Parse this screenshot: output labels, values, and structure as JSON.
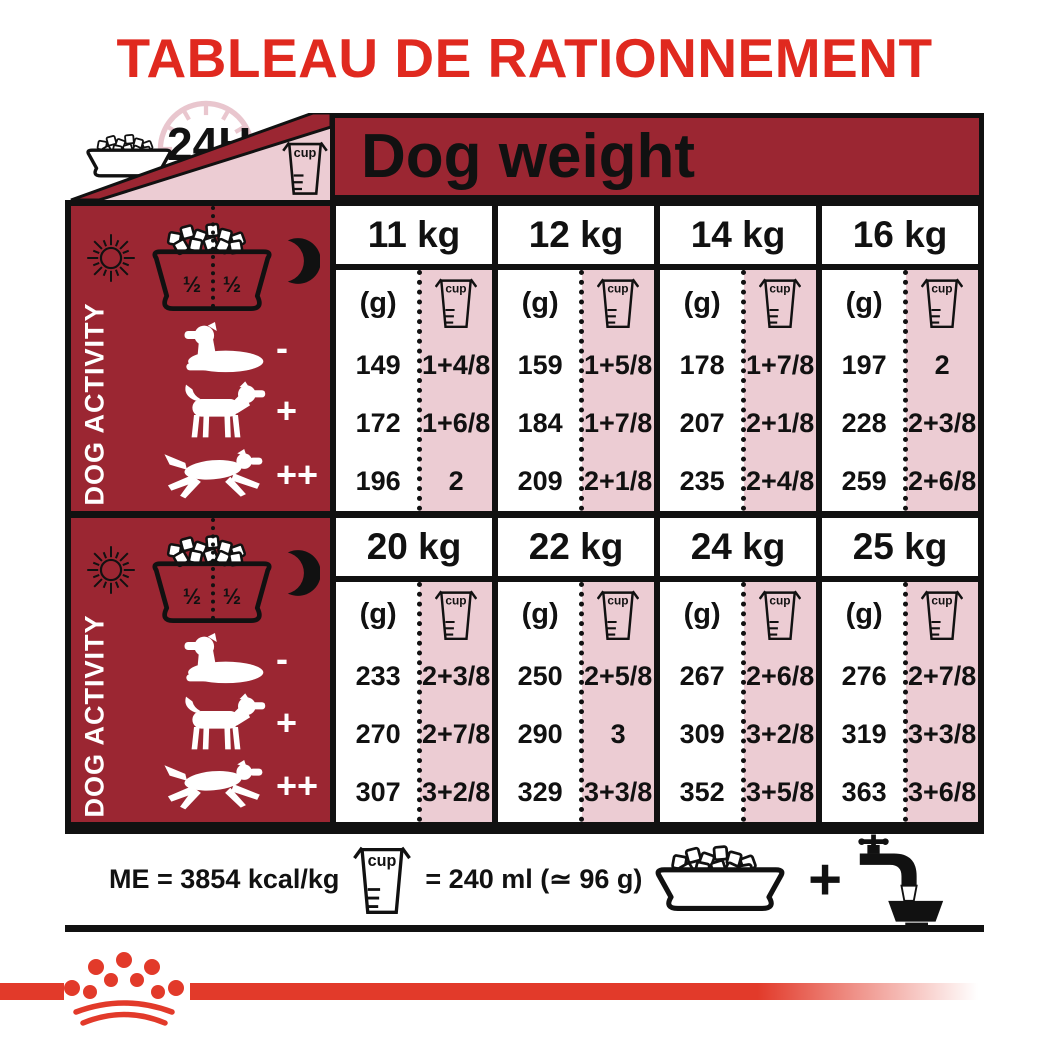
{
  "title": "TABLEAU DE RATIONNEMENT",
  "colors": {
    "accent_red": "#E0291F",
    "table_dark_red": "#9B2632",
    "pink": "#ECCCD3",
    "logo_red": "#E23A2A",
    "black": "#111111"
  },
  "top": {
    "daily": "24H",
    "cup": "cup",
    "dog_weight": "Dog weight"
  },
  "labels": {
    "unit_g": "(g)"
  },
  "activity": {
    "label": "DOG ACTIVITY",
    "half_left": "½",
    "half_right": "½",
    "markers": [
      "-",
      "+",
      "++"
    ]
  },
  "tables": [
    {
      "weights": [
        "11 kg",
        "12 kg",
        "14 kg",
        "16 kg"
      ],
      "rows": [
        {
          "cells": [
            {
              "g": "149",
              "cup": "1+4/8"
            },
            {
              "g": "159",
              "cup": "1+5/8"
            },
            {
              "g": "178",
              "cup": "1+7/8"
            },
            {
              "g": "197",
              "cup": "2"
            }
          ]
        },
        {
          "cells": [
            {
              "g": "172",
              "cup": "1+6/8"
            },
            {
              "g": "184",
              "cup": "1+7/8"
            },
            {
              "g": "207",
              "cup": "2+1/8"
            },
            {
              "g": "228",
              "cup": "2+3/8"
            }
          ]
        },
        {
          "cells": [
            {
              "g": "196",
              "cup": "2"
            },
            {
              "g": "209",
              "cup": "2+1/8"
            },
            {
              "g": "235",
              "cup": "2+4/8"
            },
            {
              "g": "259",
              "cup": "2+6/8"
            }
          ]
        }
      ]
    },
    {
      "weights": [
        "20 kg",
        "22 kg",
        "24 kg",
        "25 kg"
      ],
      "rows": [
        {
          "cells": [
            {
              "g": "233",
              "cup": "2+3/8"
            },
            {
              "g": "250",
              "cup": "2+5/8"
            },
            {
              "g": "267",
              "cup": "2+6/8"
            },
            {
              "g": "276",
              "cup": "2+7/8"
            }
          ]
        },
        {
          "cells": [
            {
              "g": "270",
              "cup": "2+7/8"
            },
            {
              "g": "290",
              "cup": "3"
            },
            {
              "g": "309",
              "cup": "3+2/8"
            },
            {
              "g": "319",
              "cup": "3+3/8"
            }
          ]
        },
        {
          "cells": [
            {
              "g": "307",
              "cup": "3+2/8"
            },
            {
              "g": "329",
              "cup": "3+3/8"
            },
            {
              "g": "352",
              "cup": "3+5/8"
            },
            {
              "g": "363",
              "cup": "3+6/8"
            }
          ]
        }
      ]
    }
  ],
  "footer": {
    "me": "ME = 3854 kcal/kg",
    "cup": "cup",
    "equiv": "= 240 ml (≃ 96 g)",
    "plus": "+"
  }
}
